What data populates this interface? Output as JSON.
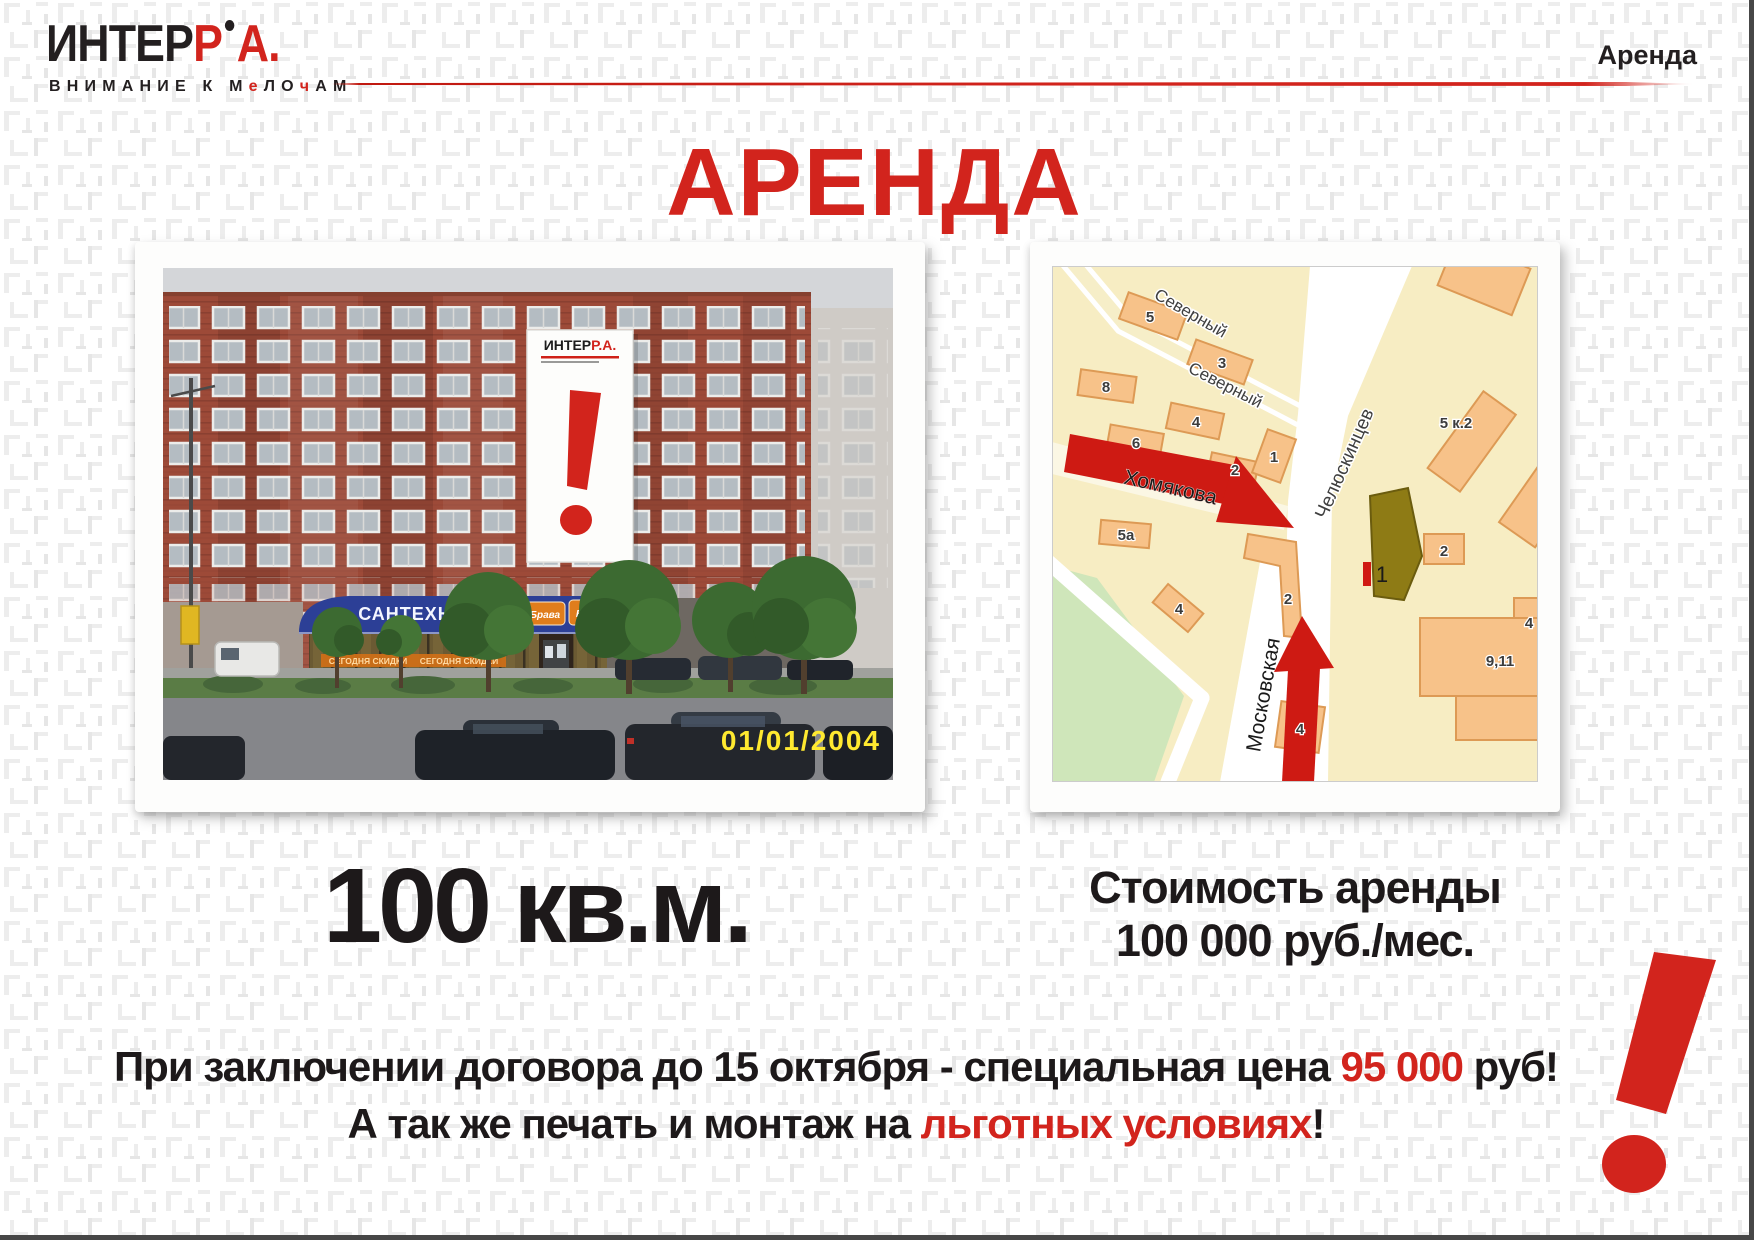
{
  "header": {
    "corner": "Аренда"
  },
  "logo": {
    "black": "ИНТЕР",
    "red_p": "Р",
    "red_a": "А",
    "period": "."
  },
  "tagline": {
    "p1": "ВНИМАНИЕ К М",
    "r1": "е",
    "p2": "ЛО",
    "r2": "ч",
    "p3": "АМ"
  },
  "title": {
    "text": "АРЕНДА"
  },
  "photo": {
    "banner_black": "ИНТЕР",
    "banner_red": "Р.А.",
    "shop_sign": "САНТЕХНИКА",
    "shop_brand": "Брава",
    "shop_brand2": "Брава",
    "discount": "СЕГОДНЯ СКИДКИ",
    "discount2": "СЕГОДНЯ СКИДКИ",
    "timestamp": "01/01/2004"
  },
  "map": {
    "street_severny": "Северный",
    "street_severny2": "Северный",
    "street_chel": "Челюскинцев",
    "street_khom": "Хомякова",
    "street_mosk": "Московская",
    "b5": "5",
    "b3": "3",
    "b8": "8",
    "b4a": "4",
    "b6": "6",
    "b2a": "2",
    "b1": "1",
    "b5a": "5а",
    "b2b": "2",
    "b4b": "4",
    "b4c": "4",
    "b5k2": "5 к.2",
    "b2c": "2",
    "b4d": "4",
    "b911": "9,11",
    "site": "1"
  },
  "area": {
    "value": "100 кв.м."
  },
  "price": {
    "line1": "Стоимость аренды",
    "line2": "100 000 руб./мес."
  },
  "offer": {
    "l1a": "При заключении договора до 15 октября - специальная цена ",
    "l1b": "95 000",
    "l1c": " руб!",
    "l2a": "А так же печать и монтаж на ",
    "l2b": "льготных условиях",
    "l2c": "!"
  },
  "colors": {
    "accent_red": "#d2241d",
    "map_arrow_red": "#ce1a13",
    "text_black": "#1d191a"
  }
}
